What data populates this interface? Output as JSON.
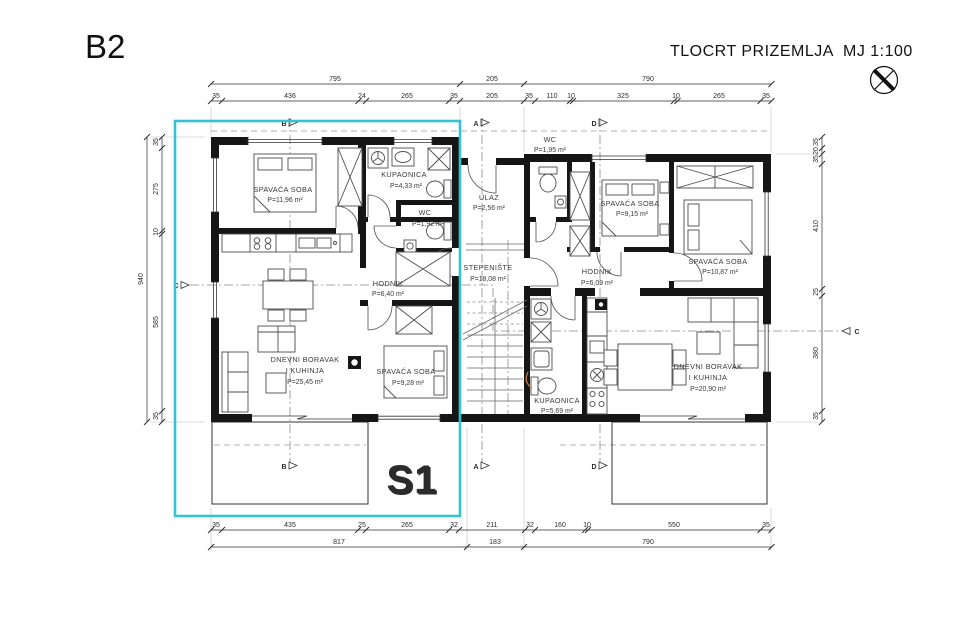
{
  "header": {
    "sheet": "B2",
    "title": "TLOCRT PRIZEMLJA",
    "scale": "MJ 1:100"
  },
  "unit": {
    "label": "S1",
    "accent": "#35c3d3"
  },
  "rooms": {
    "s1_bedroom1": {
      "name": "SPAVAĆA SOBA",
      "area": "P=11,96 m²"
    },
    "s1_bathroom": {
      "name": "KUPAONICA",
      "area": "P=4,33 m²"
    },
    "s1_wc": {
      "name": "WC",
      "area": "P=1,92 m²"
    },
    "s1_hall": {
      "name": "HODNIK",
      "area": "P=6,40 m²"
    },
    "s1_living": {
      "name1": "DNEVNI BORAVAK",
      "name2": "I KUHINJA",
      "area": "P=25,45 m²"
    },
    "s1_bedroom2": {
      "name": "SPAVAĆA SOBA",
      "area": "P=9,28 m²"
    },
    "core_wc": {
      "name": "WC",
      "area": "P=1,95 m²"
    },
    "core_entry": {
      "name": "ULAZ",
      "area": "P=2,56 m²"
    },
    "core_stairs": {
      "name": "STEPENIŠTE",
      "area": "P=18,08 m²"
    },
    "s2_hall": {
      "name": "HODNIK",
      "area": "P=6,09 m²"
    },
    "s2_bedroom1": {
      "name": "SPAVAĆA SOBA",
      "area": "P=9,15 m²"
    },
    "s2_bedroom2": {
      "name": "SPAVAĆA SOBA",
      "area": "P=10,87 m²"
    },
    "s2_bathroom": {
      "name": "KUPAONICA",
      "area": "P=5,69 m²"
    },
    "s2_living": {
      "name1": "DNEVNI BORAVAK",
      "name2": "I KUHINJA",
      "area": "P=20,90 m²"
    }
  },
  "dims": {
    "top1": [
      "795",
      "205",
      "790"
    ],
    "top2": [
      "35",
      "436",
      "24",
      "265",
      "35",
      "205",
      "35",
      "110",
      "10",
      "325",
      "10",
      "265",
      "35"
    ],
    "bottom1": [
      "35",
      "435",
      "25",
      "265",
      "32",
      "211",
      "32",
      "160",
      "10",
      "550",
      "35"
    ],
    "bottom2": [
      "817",
      "183",
      "790"
    ],
    "left": [
      "35",
      "275",
      "10",
      "585",
      "35"
    ],
    "left_total": "940",
    "right": [
      "35",
      "20",
      "35",
      "410",
      "25",
      "380",
      "35"
    ]
  },
  "markers": {
    "a": "A",
    "b": "B",
    "c": "C",
    "d": "D"
  }
}
